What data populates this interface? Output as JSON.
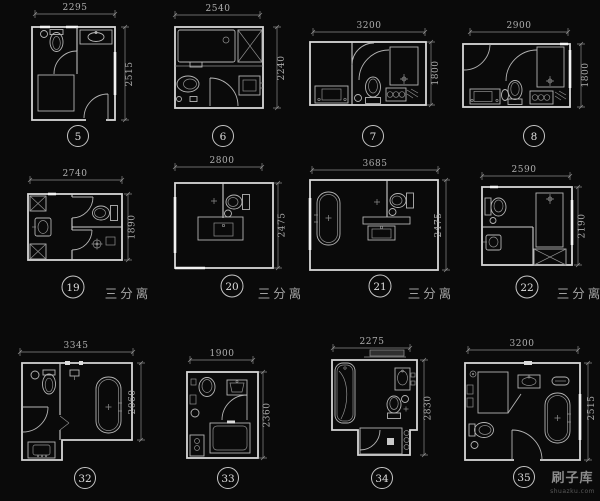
{
  "sheet": {
    "background": "#0a0a0a",
    "line_color": "#d6d6d6",
    "dim_text_color": "#aeaeae",
    "hatch_fill": "#3f3f3f"
  },
  "separator_label": "三分离",
  "watermark": {
    "name": "刷子库",
    "domain": "shuazku.com"
  },
  "plans": [
    {
      "id": "5",
      "width_mm": "2295",
      "height_mm": "2515",
      "fixtures": [
        "toilet",
        "sink",
        "shower",
        "door"
      ]
    },
    {
      "id": "6",
      "width_mm": "2540",
      "height_mm": "2240",
      "fixtures": [
        "bathtub",
        "shaft",
        "toilet",
        "sink",
        "door"
      ]
    },
    {
      "id": "7",
      "width_mm": "3200",
      "height_mm": "1800",
      "fixtures": [
        "vanity",
        "toilet",
        "shower",
        "washer",
        "door"
      ]
    },
    {
      "id": "8",
      "width_mm": "2900",
      "height_mm": "1800",
      "fixtures": [
        "door",
        "vanity",
        "toilet",
        "shower",
        "washer"
      ]
    },
    {
      "id": "19",
      "width_mm": "2740",
      "height_mm": "1890",
      "label": "三分离",
      "fixtures": [
        "shaft",
        "sink",
        "toilet",
        "shower",
        "door"
      ]
    },
    {
      "id": "20",
      "width_mm": "2800",
      "height_mm": "2475",
      "label": "三分离",
      "fixtures": [
        "toilet",
        "vanity",
        "door"
      ]
    },
    {
      "id": "21",
      "width_mm": "3685",
      "height_mm": "2475",
      "label": "三分离",
      "fixtures": [
        "bathtub",
        "toilet",
        "vanity"
      ]
    },
    {
      "id": "22",
      "width_mm": "2590",
      "height_mm": "2190",
      "label": "三分离",
      "fixtures": [
        "toilet",
        "sink",
        "shower",
        "shaft"
      ]
    },
    {
      "id": "32",
      "width_mm": "3345",
      "height_mm": "2060",
      "fixtures": [
        "toilet",
        "door",
        "bathtub",
        "sink"
      ]
    },
    {
      "id": "33",
      "width_mm": "1900",
      "height_mm": "2360",
      "fixtures": [
        "toilet",
        "sink",
        "bathtub",
        "washer",
        "door"
      ]
    },
    {
      "id": "34",
      "width_mm": "2275",
      "height_mm": "2830",
      "fixtures": [
        "bathtub",
        "sink",
        "toilet",
        "shower"
      ]
    },
    {
      "id": "35",
      "width_mm": "3200",
      "height_mm": "2515",
      "fixtures": [
        "shower",
        "sink",
        "bathtub",
        "toilet",
        "door"
      ]
    }
  ]
}
